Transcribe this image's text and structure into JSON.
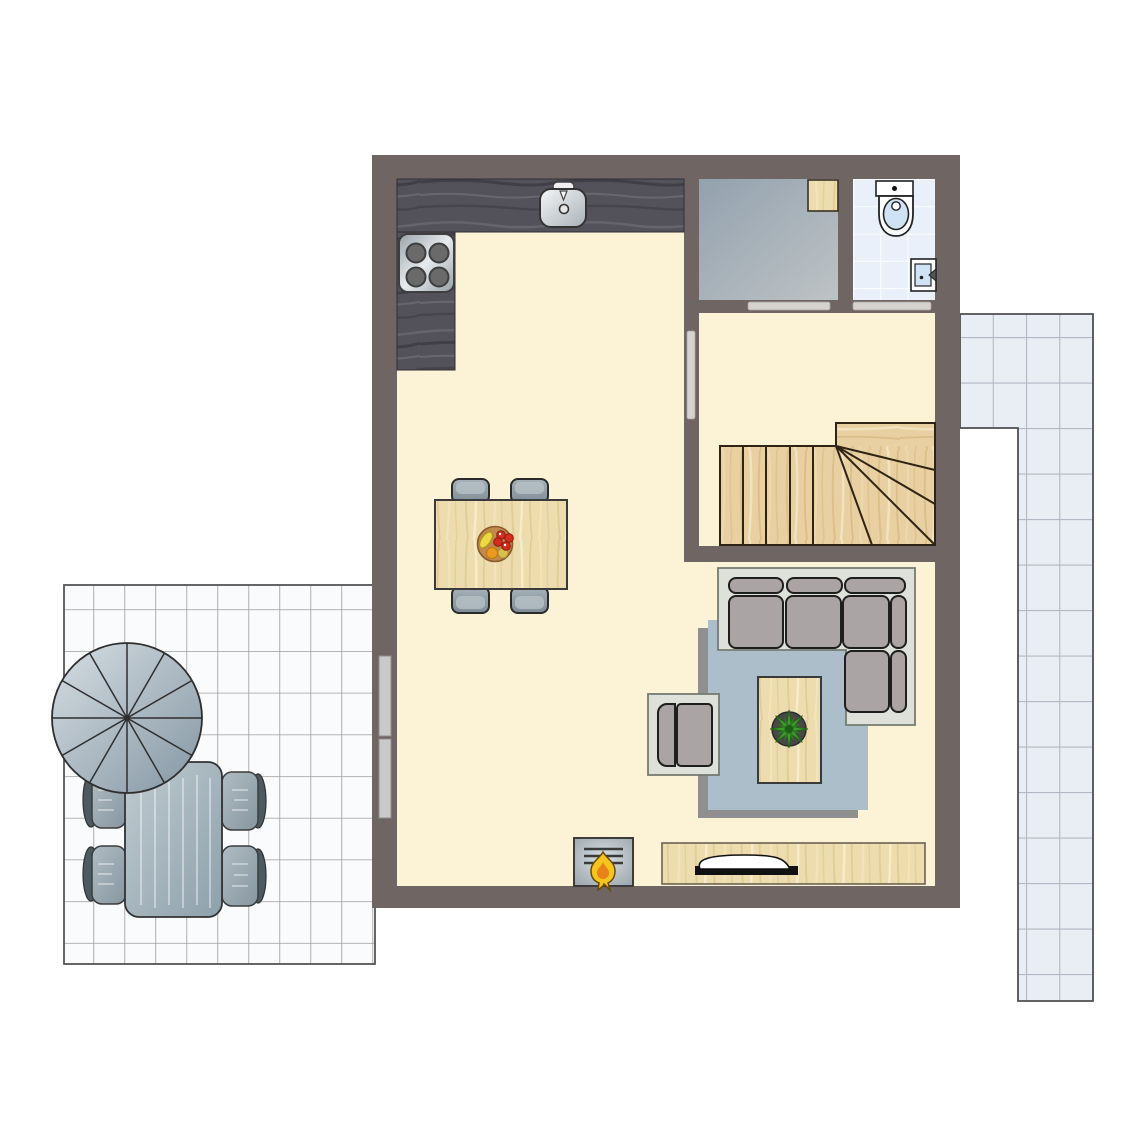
{
  "meta": {
    "type": "floor-plan",
    "view": "top-down architectural plan, no text labels visible"
  },
  "palette": {
    "background": "#ffffff",
    "wall": "#6f6663",
    "floor": "#fcf2d5",
    "counter_wood_base": "#53525a",
    "stair_wood_base": "#e8d0a2",
    "pale_wood_base": "#ecdcae",
    "utility_floor_dark": "#93a1ae",
    "utility_floor_light": "#bdc3c5",
    "bath_tile": "#e9f0fa",
    "terrace_tile": "#fafbfd",
    "path_tile": "#e9edf4",
    "rug": "#adbecb",
    "rug_shadow": "#8f8f8f",
    "sofa_base": "#dee1d9",
    "sofa_cushion": "#aba4a4",
    "door_marker": "#d6d3cf",
    "window_marker": "#c9c9c9",
    "stair_line": "#2f2413",
    "plant_green": "#3f9a2e",
    "flame_yellow": "#f6c51d",
    "fruit_bowl_brown": "#c08a4e",
    "fixture_white": "#ffffff",
    "fixture_blue": "#cfe3f5"
  },
  "rooms": [
    {
      "name": "kitchen-living-room",
      "floor": "cream"
    },
    {
      "name": "utility-room",
      "floor": "gray"
    },
    {
      "name": "bathroom",
      "floor": "light-blue tile"
    },
    {
      "name": "stair-hall",
      "floor": "cream"
    }
  ],
  "openings": {
    "door_markers": 3,
    "window_markers": 2
  },
  "furniture": {
    "kitchen": [
      "l-shaped-counter",
      "cooktop-with-4-burners",
      "kitchen-sink-with-faucet"
    ],
    "dining": [
      "wooden-dining-table",
      "4-gray-chairs",
      "fruit-bowl"
    ],
    "living": [
      "l-shaped-corner-sofa",
      "armchair",
      "coffee-table",
      "potted-plant",
      "blue-gray-rug",
      "tv-sideboard",
      "tv",
      "wood-stove-fireplace"
    ],
    "bathroom": [
      "toilet",
      "washbasin"
    ],
    "utility": [
      "wooden-shelf-box"
    ],
    "stair_hall": [
      "staircase-with-winder-steps"
    ],
    "terrace": [
      "parasol-12-segments",
      "garden-table",
      "4-garden-chairs"
    ],
    "outside_right": [
      "l-shaped-tiled-path"
    ]
  }
}
